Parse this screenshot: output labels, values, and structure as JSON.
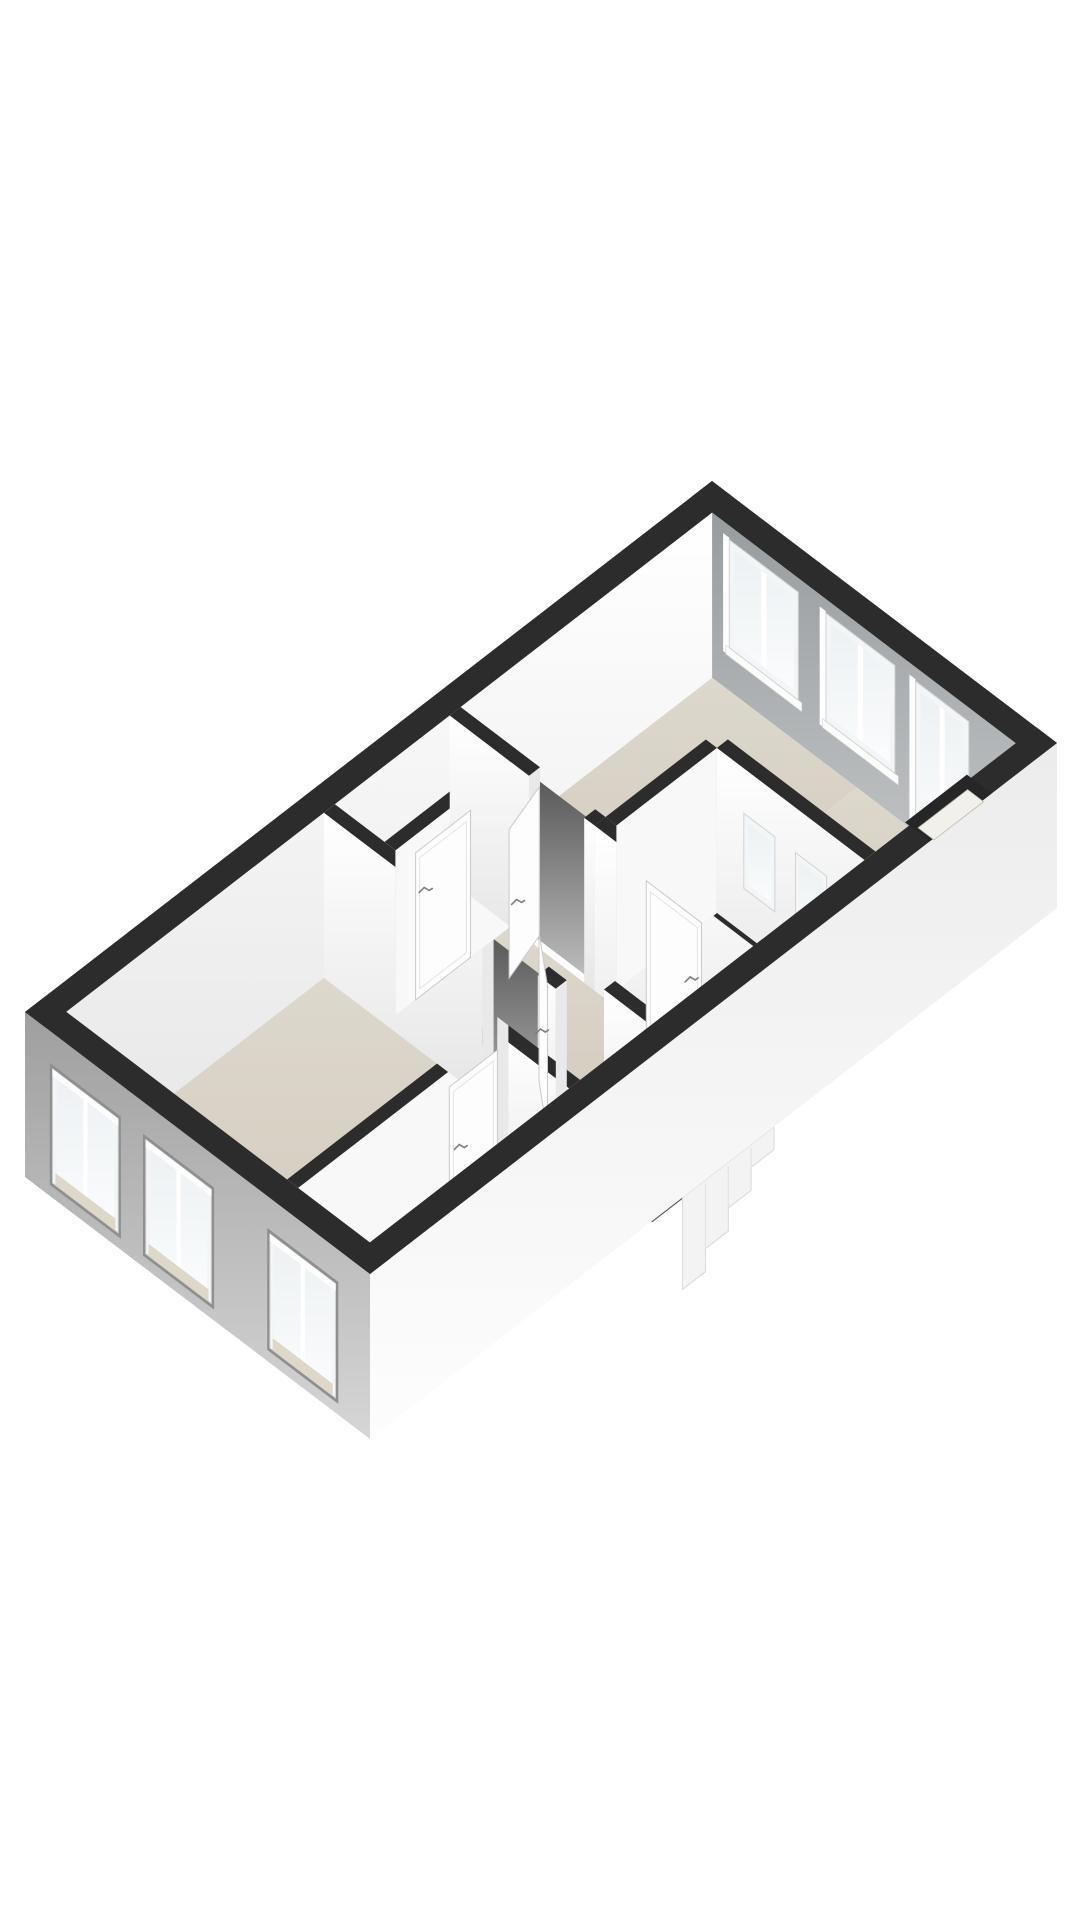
{
  "page": {
    "background": "#ffffff",
    "width": 1080,
    "height": 1920
  },
  "figure": {
    "kind": "3d-floor-plan-render",
    "storey": "upper-floor",
    "visible_text": ""
  },
  "scene": {
    "projection": {
      "ox": 25,
      "oy": 1012,
      "ux": 68.7,
      "uy": -53.1,
      "vx": 69,
      "vy": 52.4
    },
    "wall_drop": 165,
    "exterior": {
      "thickness": 0.3,
      "u_max": 10,
      "v_max": 5,
      "inner": {
        "u1": 0.3,
        "u2": 9.7,
        "v1": 0.3,
        "v2": 4.7
      }
    },
    "colors": {
      "black": "#2c2c2c",
      "face_top": "#ffffff",
      "face_bot": "#e6e6e6",
      "face_flat": "#f8f8f8",
      "cut": "#e9e9e9",
      "ne_top": "#979c9f",
      "ne_bot": "#c6c8c9",
      "sw_top": "#9f9f9f",
      "sw_bot": "#d6d6d6",
      "se_top": "#ececec",
      "se_bot": "#fdfdfd",
      "floor_top": "#ddd8cc",
      "floor_bot": "#d0cabc",
      "floor_light": "#e8e6e0",
      "closet_floor": "#d8d6d1",
      "gap_top": "#585858",
      "gap_bot": "#bdbdbd",
      "glass_top": "#edf1f3",
      "glass_bot": "#fafcfd",
      "frame": "#f4f5f6",
      "frame_edge": "#cfd4d6",
      "sill_beige": "#ded8c9",
      "void_fill": "#4c4c4c",
      "tread_a": "#747474",
      "tread_b": "#646464",
      "tread_c": "#575757",
      "stair_fill": "#f3f3f3",
      "stair_edge": "#d9d9d9",
      "door": "#fdfdfd",
      "door_edge": "#c9c9c9",
      "door_line": "#e4e4e4",
      "handle": "#7f7f7f",
      "reveal_dark": "#8f8f8f",
      "reveal_light": "#ffffff",
      "notch_sill": "#f2f0ea",
      "shadow": "rgba(0,0,0,0.12)"
    },
    "floors": [
      {
        "name": "room-floor-bedroom",
        "r": [
          0.3,
          0.3,
          4.05,
          3.5
        ],
        "fill": "floor"
      },
      {
        "name": "room-floor-front-room",
        "r": [
          0.3,
          3.66,
          3.2,
          4.7
        ],
        "fill": "floor"
      },
      {
        "name": "room-floor-hall-main",
        "r": [
          4.21,
          1.18,
          5.88,
          4.02
        ],
        "fill": "floor"
      },
      {
        "name": "room-floor-hall-side",
        "r": [
          3.36,
          3.5,
          4.39,
          4.7
        ],
        "fill": "floor"
      },
      {
        "name": "room-floor-living-main",
        "r": [
          6.04,
          0.3,
          9.7,
          2.4
        ],
        "fill": "floor"
      },
      {
        "name": "room-floor-living-front",
        "r": [
          7.66,
          2.4,
          9.7,
          4.7
        ],
        "fill": "floor"
      },
      {
        "name": "room-floor-bathroom",
        "r": [
          6.04,
          2.56,
          7.5,
          4.7
        ],
        "fill": "floor_light"
      },
      {
        "name": "room-floor-closet",
        "r": [
          4.21,
          0.3,
          5.88,
          1.02
        ],
        "fill": "closet"
      }
    ],
    "walls_sequence": [
      "w2",
      "w1",
      "w4",
      "w5",
      "w3",
      "w7",
      "w8",
      "w6",
      "w9"
    ],
    "walls": {
      "w2": {
        "kind": "v",
        "v": [
          3.5,
          3.66
        ],
        "u": [
          0.3,
          3.36
        ],
        "gaps": []
      },
      "w1": {
        "kind": "u",
        "u": [
          4.05,
          4.21
        ],
        "v": [
          0.3,
          3.66
        ],
        "gaps": [
          [
            2.6,
            3.4
          ]
        ]
      },
      "w4": {
        "kind": "v",
        "v": [
          1.02,
          1.18
        ],
        "u": [
          4.21,
          5.88
        ],
        "gaps": []
      },
      "w5": {
        "kind": "u",
        "u": [
          5.88,
          6.04
        ],
        "v": [
          0.3,
          2.4
        ],
        "gaps": [
          [
            1.45,
            2.25
          ]
        ]
      },
      "w3": {
        "kind": "u",
        "u": [
          3.2,
          3.36
        ],
        "v": [
          3.66,
          4.7
        ],
        "gaps": []
      },
      "w7": {
        "kind": "u",
        "u": [
          5.88,
          6.04
        ],
        "v": [
          2.4,
          4.7
        ],
        "gaps": []
      },
      "w8": {
        "kind": "v",
        "v": [
          2.4,
          2.56
        ],
        "u": [
          6.04,
          7.5
        ],
        "gaps": []
      },
      "w6": {
        "kind": "u",
        "u": [
          4.39,
          4.55
        ],
        "v": [
          4.02,
          4.7
        ],
        "gaps": []
      },
      "w9": {
        "kind": "u",
        "u": [
          7.5,
          7.66
        ],
        "v": [
          2.56,
          4.7
        ],
        "gaps": []
      }
    },
    "extra_cuts": [
      {
        "kind": "u",
        "at": 3.36,
        "v": [
          3.5,
          3.66
        ]
      },
      {
        "kind": "v",
        "at": 3.66,
        "u": [
          4.05,
          4.21
        ]
      }
    ],
    "ne_windows": [
      {
        "v": [
          0.55,
          1.55
        ],
        "h": [
          14,
          122
        ]
      },
      {
        "v": [
          1.95,
          2.95
        ],
        "h": [
          14,
          122
        ]
      },
      {
        "v": [
          3.25,
          4.02
        ],
        "h": [
          14,
          152
        ]
      }
    ],
    "sw_windows": [
      {
        "v": [
          0.4,
          1.35
        ],
        "h": [
          36,
          150
        ]
      },
      {
        "v": [
          1.75,
          2.7
        ],
        "h": [
          36,
          150
        ]
      },
      {
        "v": [
          3.55,
          4.5
        ],
        "h": [
          36,
          150
        ]
      }
    ],
    "interior_windows": [
      {
        "plane_u": 7.5,
        "v": [
          2.95,
          3.4
        ],
        "h": [
          45,
          120
        ]
      },
      {
        "plane_u": 7.5,
        "v": [
          3.7,
          4.15
        ],
        "h": [
          45,
          120
        ]
      }
    ],
    "se_high_window": {
      "dark": [
        8.15,
        4.64,
        9.05,
        5.0
      ],
      "sill": [
        8.24,
        4.74,
        8.96,
        4.97
      ],
      "sill_h": 5
    },
    "open_doors": [
      {
        "name": "door-bedroom",
        "hinge": [
          4.17,
          3.42
        ],
        "end": [
          4.62,
          2.85
        ],
        "top": 16,
        "handle_f": 0.72,
        "handle_h": 84
      },
      {
        "name": "door-living",
        "hinge": [
          6.0,
          1.48
        ],
        "end": [
          5.38,
          1.66
        ],
        "top": 16,
        "handle_f": 0.72,
        "handle_h": 84
      }
    ],
    "closed_doors": [
      {
        "name": "door-front-room",
        "plane": "v",
        "at": 3.66,
        "c": [
          2.5,
          3.2
        ],
        "top": 16,
        "handle": [
          2.66,
          84
        ]
      },
      {
        "name": "door-closet",
        "plane": "v",
        "at": 1.18,
        "c": [
          4.5,
          5.3
        ],
        "top": 18,
        "handle": [
          4.64,
          62
        ]
      },
      {
        "name": "door-bathroom",
        "plane": "u",
        "at": 5.88,
        "c": [
          3.15,
          3.95
        ],
        "top": 16,
        "handle": [
          3.8,
          80
        ]
      }
    ],
    "stair_void": {
      "u": [
        4.55,
        5.88
      ],
      "v": [
        4.14,
        4.7
      ],
      "edge_v": [
        4.02,
        4.14
      ],
      "treads": 3,
      "tread_dv": 0.14,
      "tread_dh": 16
    },
    "stair_out": {
      "u": [
        4.55,
        5.88
      ],
      "drop": 92,
      "steps": 4
    },
    "closet_shadow": {
      "tri": [
        [
          4.21,
          0.3
        ],
        [
          5.88,
          0.3
        ],
        [
          4.21,
          1.02
        ]
      ]
    }
  }
}
